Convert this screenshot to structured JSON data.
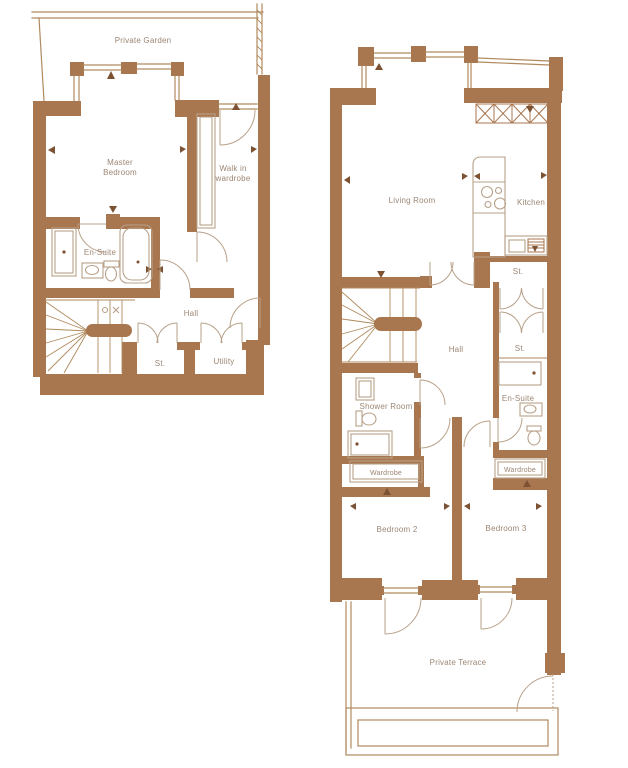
{
  "colors": {
    "background": "#ffffff",
    "wall": "#a8764f",
    "line": "#b08a5e",
    "fixture": "#b7a189",
    "label_text": "#9c8674",
    "marker": "#7d5233"
  },
  "left_plan": {
    "labels": {
      "private_garden": "Private Garden",
      "master_bedroom": [
        "Master",
        "Bedroom"
      ],
      "walk_in_wardrobe": [
        "Walk in",
        "wardrobe"
      ],
      "en_suite": "En-Suite",
      "hall": "Hall",
      "storage": "St.",
      "utility": "Utility"
    }
  },
  "right_plan": {
    "labels": {
      "living_room": "Living Room",
      "kitchen": "Kitchen",
      "storage_upper": "St.",
      "hall": "Hall",
      "storage_middle": "St.",
      "shower_room": "Shower Room",
      "en_suite": "En-Suite",
      "wardrobe_left": "Wardrobe",
      "wardrobe_right": "Wardrobe",
      "bedroom_2": "Bedroom 2",
      "bedroom_3": "Bedroom 3",
      "private_terrace": "Private Terrace"
    }
  }
}
